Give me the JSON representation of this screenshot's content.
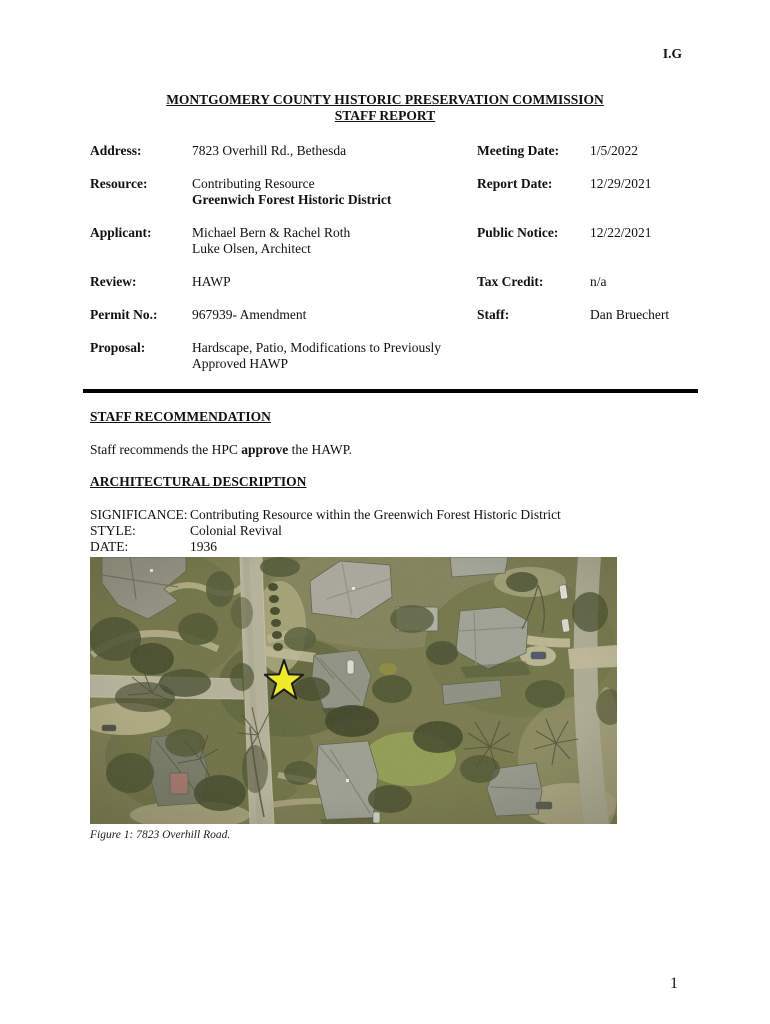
{
  "page": {
    "corner_mark": "I.G",
    "page_number": "1"
  },
  "header": {
    "title_line1": "MONTGOMERY COUNTY HISTORIC PRESERVATION COMMISSION",
    "title_line2": "STAFF REPORT"
  },
  "info_table": {
    "rows": [
      {
        "label": "Address:",
        "value_lines": [
          "7823 Overhill Rd., Bethesda"
        ],
        "bold_line": -1,
        "label2": "Meeting Date:",
        "value2": "1/5/2022"
      },
      {
        "label": "Resource:",
        "value_lines": [
          "Contributing Resource",
          "Greenwich Forest Historic District"
        ],
        "bold_line": 1,
        "label2": "Report Date:",
        "value2": "12/29/2021"
      },
      {
        "label": "Applicant:",
        "value_lines": [
          "Michael Bern & Rachel Roth",
          "Luke Olsen, Architect"
        ],
        "bold_line": -1,
        "label2": "Public Notice:",
        "value2": "12/22/2021"
      },
      {
        "label": "Review:",
        "value_lines": [
          "HAWP"
        ],
        "bold_line": -1,
        "label2": "Tax Credit:",
        "value2": "n/a"
      },
      {
        "label": "Permit No.:",
        "value_lines": [
          "967939- Amendment"
        ],
        "bold_line": -1,
        "label2": "Staff:",
        "value2": "Dan Bruechert"
      },
      {
        "label": "Proposal:",
        "value_lines": [
          "Hardscape, Patio, Modifications to Previously Approved HAWP"
        ],
        "bold_line": -1,
        "label2": "",
        "value2": ""
      }
    ]
  },
  "sections": {
    "recommendation_heading": "STAFF RECOMMENDATION",
    "recommendation_text_pre": "Staff recommends the HPC ",
    "recommendation_text_bold": "approve",
    "recommendation_text_post": " the HAWP.",
    "description_heading": "ARCHITECTURAL DESCRIPTION",
    "details": [
      {
        "label": "SIGNIFICANCE:",
        "value": "Contributing Resource within the Greenwich Forest Historic District"
      },
      {
        "label": "STYLE:",
        "value": "Colonial Revival"
      },
      {
        "label": "DATE:",
        "value": "1936"
      }
    ]
  },
  "figure": {
    "caption": "Figure 1: 7823 Overhill Road.",
    "star_color": "#f3ee20"
  }
}
